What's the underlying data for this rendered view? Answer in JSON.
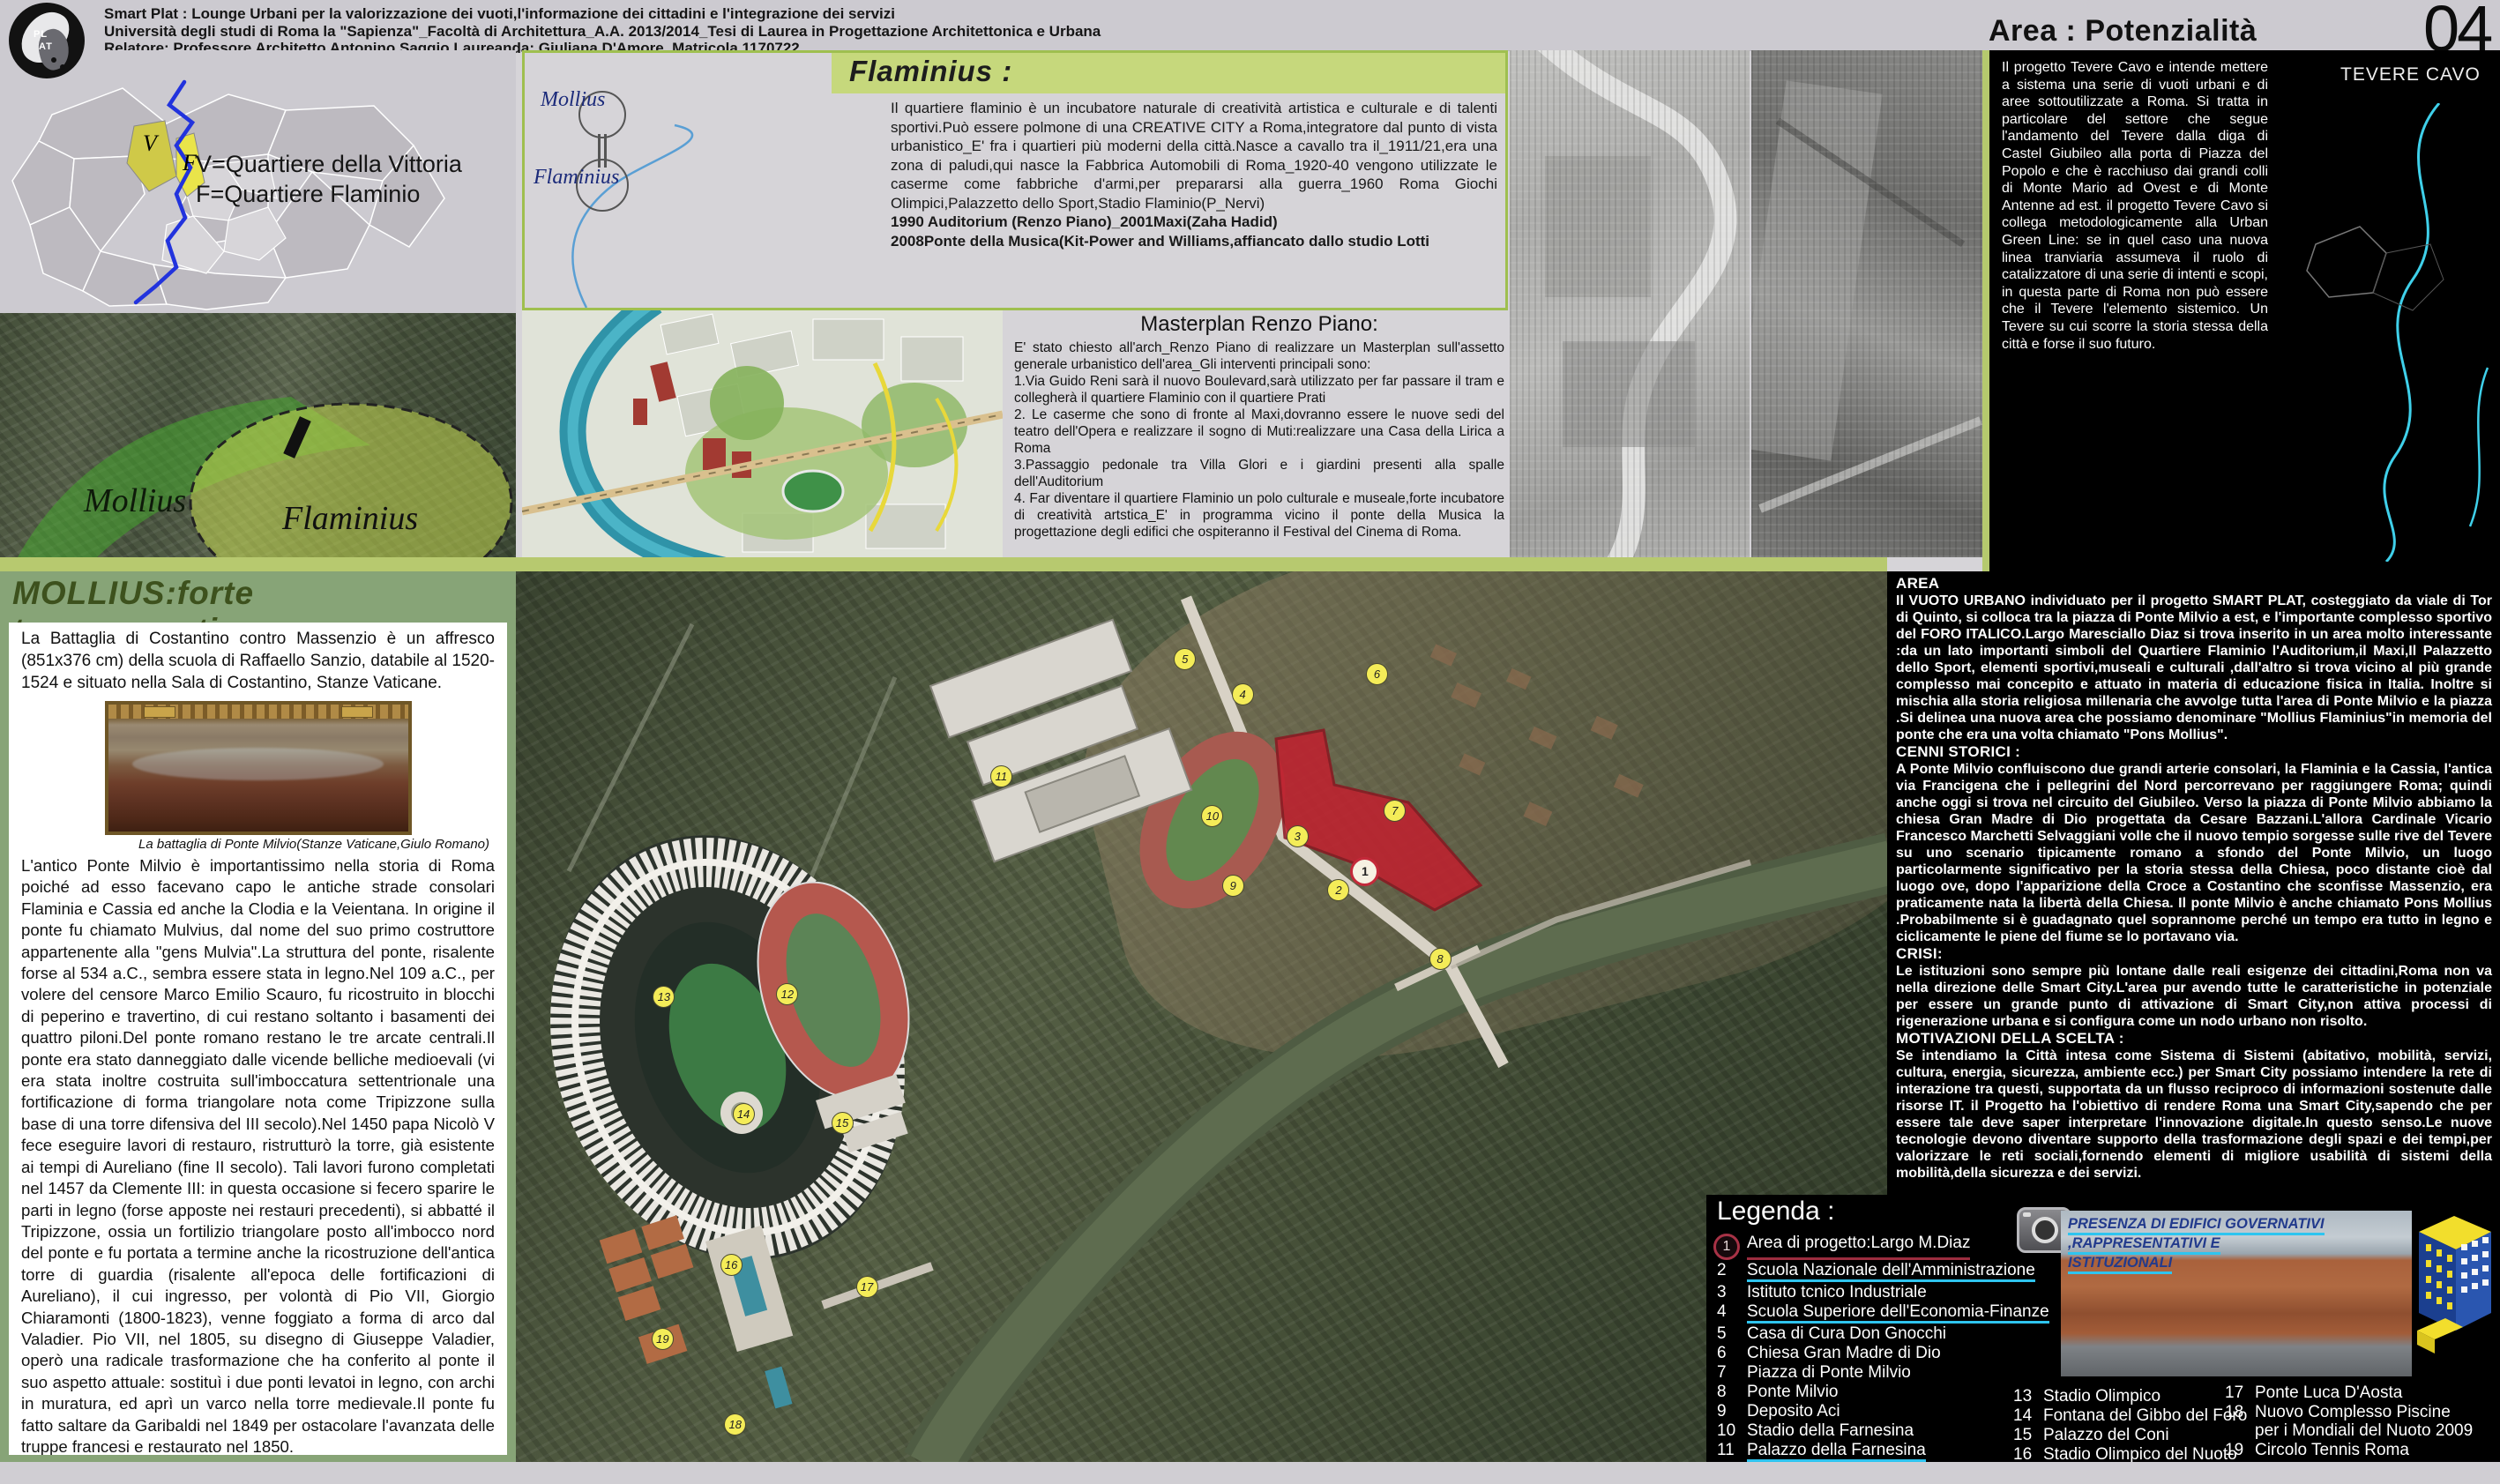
{
  "header": {
    "line1": "Smart Plat : Lounge Urbani per la valorizzazione dei vuoti,l'informazione dei cittadini e l'integrazione dei servizi",
    "line2": "Università degli studi di Roma la \"Sapienza\"_Facoltà di Architettura_A.A. 2013/2014_Tesi di Laurea in Progettazione Architettonica e Urbana",
    "line3": "Relatore: Professore Architetto Antonino Saggio Laureanda: Giuliana D'Amore_Matricola 1170722",
    "area_title": "Area : Potenzialità  inespresse",
    "page_number": "04",
    "logo_top": "PL",
    "logo_bottom": "AT"
  },
  "map_panel": {
    "key_line1": "V=Quartiere della Vittoria",
    "key_line2": "F=Quartiere Flaminio",
    "label_v": "V",
    "label_f": "F",
    "overlay_mollius": "Mollius",
    "overlay_flaminius": "Flaminius"
  },
  "flaminius": {
    "title": "Flaminius :",
    "diagram_top": "Mollius",
    "diagram_bottom": "Flaminius",
    "body": "Il quartiere flaminio è un incubatore naturale di creatività artistica e culturale e di talenti sportivi.Può essere polmone di una CREATIVE CITY a Roma,integratore dal punto di vista urbanistico_E' fra i quartieri più moderni della città.Nasce a cavallo tra il_1911/21,era una zona di paludi,qui nasce la Fabbrica Automobili di Roma_1920-40 vengono utilizzate le caserme come fabbriche d'armi,per prepararsi alla guerra_1960 Roma Giochi Olimpici,Palazzetto dello Sport,Stadio Flaminio(P_Nervi)",
    "line_1990": "1990 Auditorium (Renzo Piano)_2001Maxi(Zaha Hadid)",
    "line_2008": "2008Ponte della Musica(Kit-Power and Williams,affiancato dallo studio Lotti"
  },
  "masterplan": {
    "title": "Masterplan Renzo Piano:",
    "intro": "E' stato chiesto all'arch_Renzo Piano di realizzare un Masterplan sull'assetto generale urbanistico dell'area_Gli interventi principali sono:",
    "points": [
      {
        "text": "1.Via Guido Reni sarà il nuovo Boulevard,sarà utilizzato per far passare il tram e collegherà il quartiere Flaminio con il quartiere Prati"
      },
      {
        "text": "2. Le caserme che sono di fronte al Maxi,dovranno essere le nuove sedi del teatro dell'Opera e realizzare il sogno di Muti:realizzare una Casa della Lirica a Roma"
      },
      {
        "text": "3.Passaggio pedonale tra Villa Glori e i giardini  presenti alla spalle dell'Auditorium"
      },
      {
        "text": "4. Far diventare il quartiere Flaminio un polo culturale e museale,forte incubatore di creatività artstica_E' in programma vicino il ponte della Musica la progettazione degli edifici che ospiteranno il Festival del Cinema di Roma."
      }
    ]
  },
  "tevere": {
    "title": "TEVERE CAVO",
    "body": "Il progetto Tevere Cavo e intende mettere a sistema una serie di vuoti urbani e di aree sottoutilizzate a Roma. Si tratta in particolare del settore che segue l'andamento del Tevere dalla diga di Castel Giubileo alla porta di Piazza del Popolo e che è racchiuso dai grandi colli di Monte Mario ad Ovest e di Monte Antenne ad est. il progetto Tevere Cavo si collega metodologicamente alla Urban Green Line: se in quel caso una nuova linea tranviaria assumeva il ruolo di catalizzatore di una serie di intenti e scopi, in questa parte di Roma non può essere che il Tevere l'elemento sistemico. Un Tevere su cui scorre la storia stessa della città e forse il suo futuro."
  },
  "mollius_panel": {
    "title": "MOLLIUS:forte toponomastica",
    "intro": "La Battaglia di Costantino contro Massenzio è un affresco (851x376 cm) della scuola di Raffaello Sanzio, databile al 1520-1524 e situato nella Sala di Costantino, Stanze Vaticane.",
    "caption": "La battaglia di Ponte Milvio(Stanze Vaticane,Giulo Romano)",
    "body": "L'antico Ponte Milvio è importantissimo nella storia di Roma poiché ad esso facevano capo le antiche strade consolari Flaminia e Cassia ed anche la Clodia e la Veientana. In origine il ponte fu chiamato Mulvius, dal nome del suo primo costruttore appartenente alla \"gens Mulvia\".La struttura del ponte, risalente forse al 534 a.C., sembra essere stata in legno.Nel 109 a.C., per volere del censore Marco Emilio Scauro, fu ricostruito in blocchi di peperino e travertino, di cui restano soltanto i basamenti dei quattro piloni.Del ponte romano restano le tre arcate centrali.Il ponte era stato danneggiato dalle vicende belliche medioevali (vi era stata inoltre costruita sull'imboccatura settentrionale una fortificazione di forma triangolare nota come Tripizzone sulla base di una torre difensiva del III secolo).Nel 1450 papa Nicolò V fece eseguire lavori di restauro, ristrutturò la torre, già esistente ai tempi di Aureliano (fine II secolo). Tali lavori furono completati nel 1457 da Clemente III: in questa occasione si fecero sparire le parti in legno (forse apposte nei restauri precedenti), si abbatté il Tripizzone, ossia un fortilizio triangolare posto all'imbocco nord del ponte e fu portata a termine anche la ricostruzione dell'antica torre di guardia (risalente all'epoca delle fortificazioni di Aureliano), il cui ingresso, per volontà di Pio VII, Giorgio Chiaramonti (1800-1823), venne foggiato a forma di arco dal Valadier. Pio VII, nel 1805, su disegno di Giuseppe Valadier, operò una radicale trasformazione che ha conferito al ponte il suo aspetto attuale: sostituì i due ponti levatoi in legno,  con archi in muratura, ed aprì un varco nella torre medievale.Il ponte fu fatto saltare da Garibaldi nel 1849 per ostacolare l'avanzata delle truppe francesi e restaurato  nel 1850."
  },
  "area_column": {
    "sections": [
      {
        "heading": "AREA",
        "text": "Il VUOTO URBANO individuato per il progetto SMART PLAT, costeggiato da viale di Tor di Quinto, si colloca tra la piazza di Ponte Milvio a est, e l'importante complesso sportivo del FORO ITALICO.Largo Maresciallo Diaz si trova inserito in un area molto interessante :da un lato importanti simboli del Quartiere Flaminio l'Auditorium,il Maxi,Il Palazzetto dello Sport, elementi sportivi,museali e culturali ,dall'altro si trova vicino al più grande complesso mai concepito e attuato in materia di educazione fisica in Italia. Inoltre si mischia alla storia religiosa millenaria che avvolge tutta l'area di Ponte Milvio e la piazza .Si delinea una nuova area che possiamo denominare \"Mollius Flaminius\"in memoria del ponte che era una volta chiamato \"Pons Mollius\"."
      },
      {
        "heading": "CENNI STORICI :",
        "text": "A Ponte Milvio confluiscono due grandi arterie consolari, la Flaminia e la Cassia, l'antica via Francigena che i pellegrini del Nord percorrevano per raggiungere Roma; quindi anche oggi si trova nel circuito del Giubileo. Verso la piazza di Ponte Milvio abbiamo la chiesa Gran Madre di Dio progettata da Cesare Bazzani.L'allora Cardinale Vicario Francesco Marchetti Selvaggiani volle che il nuovo tempio sorgesse sulle rive del Tevere su uno scenario tipicamente romano a sfondo del Ponte Milvio, un luogo particolarmente significativo per la storia stessa della Chiesa, poco distante cioè dal luogo ove, dopo l'apparizione della Croce a Costantino che sconfisse Massenzio, era praticamente nata la libertà della Chiesa. Il ponte Milvio è anche chiamato Pons Mollius .Probabilmente si è guadagnato quel soprannome perché un tempo era tutto in legno e ciclicamente le piene del fiume se lo portavano via."
      },
      {
        "heading": "CRISI:",
        "text": "Le istituzioni sono sempre più lontane dalle reali esigenze dei cittadini,Roma non va nella direzione delle Smart City.L'area pur avendo  tutte le caratteristiche in potenziale per essere un grande punto di attivazione di Smart City,non attiva processi di rigenerazione urbana e si configura come un nodo urbano non risolto."
      },
      {
        "heading": "MOTIVAZIONI DELLA SCELTA :",
        "text": "Se intendiamo la Città intesa come Sistema di Sistemi (abitativo, mobilità, servizi, cultura, energia, sicurezza, ambiente ecc.) per Smart City possiamo intendere la rete di interazione tra questi, supportata da un flusso reciproco di informazioni sostenute dalle risorse IT. il Progetto ha l'obiettivo di rendere Roma una Smart City,sapendo che per essere tale deve saper interpretare l'innovazione digitale.In questo senso.Le nuove tecnologie devono diventare supporto della trasformazione degli spazi e dei tempi,per valorizzare le reti sociali,fornendo elementi di migliore usabilità di sistemi della mobilità,della sicurezza e dei servizi."
      }
    ]
  },
  "legend": {
    "title": "Legenda :",
    "col1": [
      {
        "num": "1",
        "label": "Area di progetto:Largo M.Diaz",
        "u": "red",
        "circled": true
      },
      {
        "num": "2",
        "label": "Scuola Nazionale dell'Amministrazione",
        "u": "cyan"
      },
      {
        "num": "3",
        "label": "Istituto tcnico Industriale"
      },
      {
        "num": "4",
        "label": "Scuola Superiore dell'Economia-Finanze",
        "u": "cyan"
      },
      {
        "num": "5",
        "label": "Casa di Cura Don Gnocchi"
      },
      {
        "num": "6",
        "label": "Chiesa Gran Madre di Dio"
      },
      {
        "num": "7",
        "label": "Piazza di Ponte Milvio"
      },
      {
        "num": "8",
        "label": "Ponte Milvio"
      },
      {
        "num": "9",
        "label": "Deposito Aci"
      },
      {
        "num": "10",
        "label": "Stadio  della Farnesina"
      },
      {
        "num": "11",
        "label": "Palazzo della Farnesina",
        "u": "cyan"
      },
      {
        "num": "12",
        "label": "Stadio dei Marmi"
      }
    ],
    "col2": [
      {
        "num": "13",
        "label": "Stadio Olimpico"
      },
      {
        "num": "14",
        "label": "Fontana del Gibbo del Foro"
      },
      {
        "num": "15",
        "label": "Palazzo del Coni"
      },
      {
        "num": "16",
        "label": "Stadio Olimpico del Nuoto"
      }
    ],
    "col3": [
      {
        "num": "17",
        "label": "Ponte Luca D'Aosta"
      },
      {
        "num": "18",
        "label": "Nuovo Complesso Piscine",
        "line2": "per i Mondiali del Nuoto 2009"
      },
      {
        "num": "19",
        "label": "Circolo Tennis Roma"
      }
    ],
    "photo_caption_line1": "PRESENZA DI EDIFICI GOVERNATIVI ,RAPPRESENTATIVI E",
    "photo_caption_line2": "ISTITUZIONALI"
  },
  "markers": [
    {
      "n": "1",
      "x": 61.7,
      "y": 33.3,
      "red": true
    },
    {
      "n": "2",
      "x": 59.9,
      "y": 35.6
    },
    {
      "n": "3",
      "x": 56.9,
      "y": 29.5
    },
    {
      "n": "4",
      "x": 52.9,
      "y": 13.6
    },
    {
      "n": "5",
      "x": 48.7,
      "y": 9.7
    },
    {
      "n": "6",
      "x": 62.7,
      "y": 11.4
    },
    {
      "n": "7",
      "x": 64.0,
      "y": 26.7
    },
    {
      "n": "8",
      "x": 67.3,
      "y": 43.3
    },
    {
      "n": "9",
      "x": 52.2,
      "y": 35.1
    },
    {
      "n": "10",
      "x": 50.7,
      "y": 27.3
    },
    {
      "n": "11",
      "x": 35.3,
      "y": 22.8
    },
    {
      "n": "12",
      "x": 19.7,
      "y": 47.2
    },
    {
      "n": "13",
      "x": 10.7,
      "y": 47.5
    },
    {
      "n": "14",
      "x": 16.5,
      "y": 60.7
    },
    {
      "n": "15",
      "x": 23.7,
      "y": 61.7
    },
    {
      "n": "16",
      "x": 15.6,
      "y": 77.6
    },
    {
      "n": "17",
      "x": 25.5,
      "y": 80.0
    },
    {
      "n": "18",
      "x": 15.9,
      "y": 95.5
    },
    {
      "n": "19",
      "x": 10.6,
      "y": 85.9
    }
  ],
  "colors": {
    "accent_green": "#b7c96f",
    "band_green": "#c6d87c",
    "panel_green": "#87a477",
    "legend_cyan": "#2ec4ef",
    "legend_red": "#9b2d3f",
    "project_red": "#c21f2e",
    "river_teal": "#2f93a8",
    "map_yellow": "#cfc948"
  }
}
